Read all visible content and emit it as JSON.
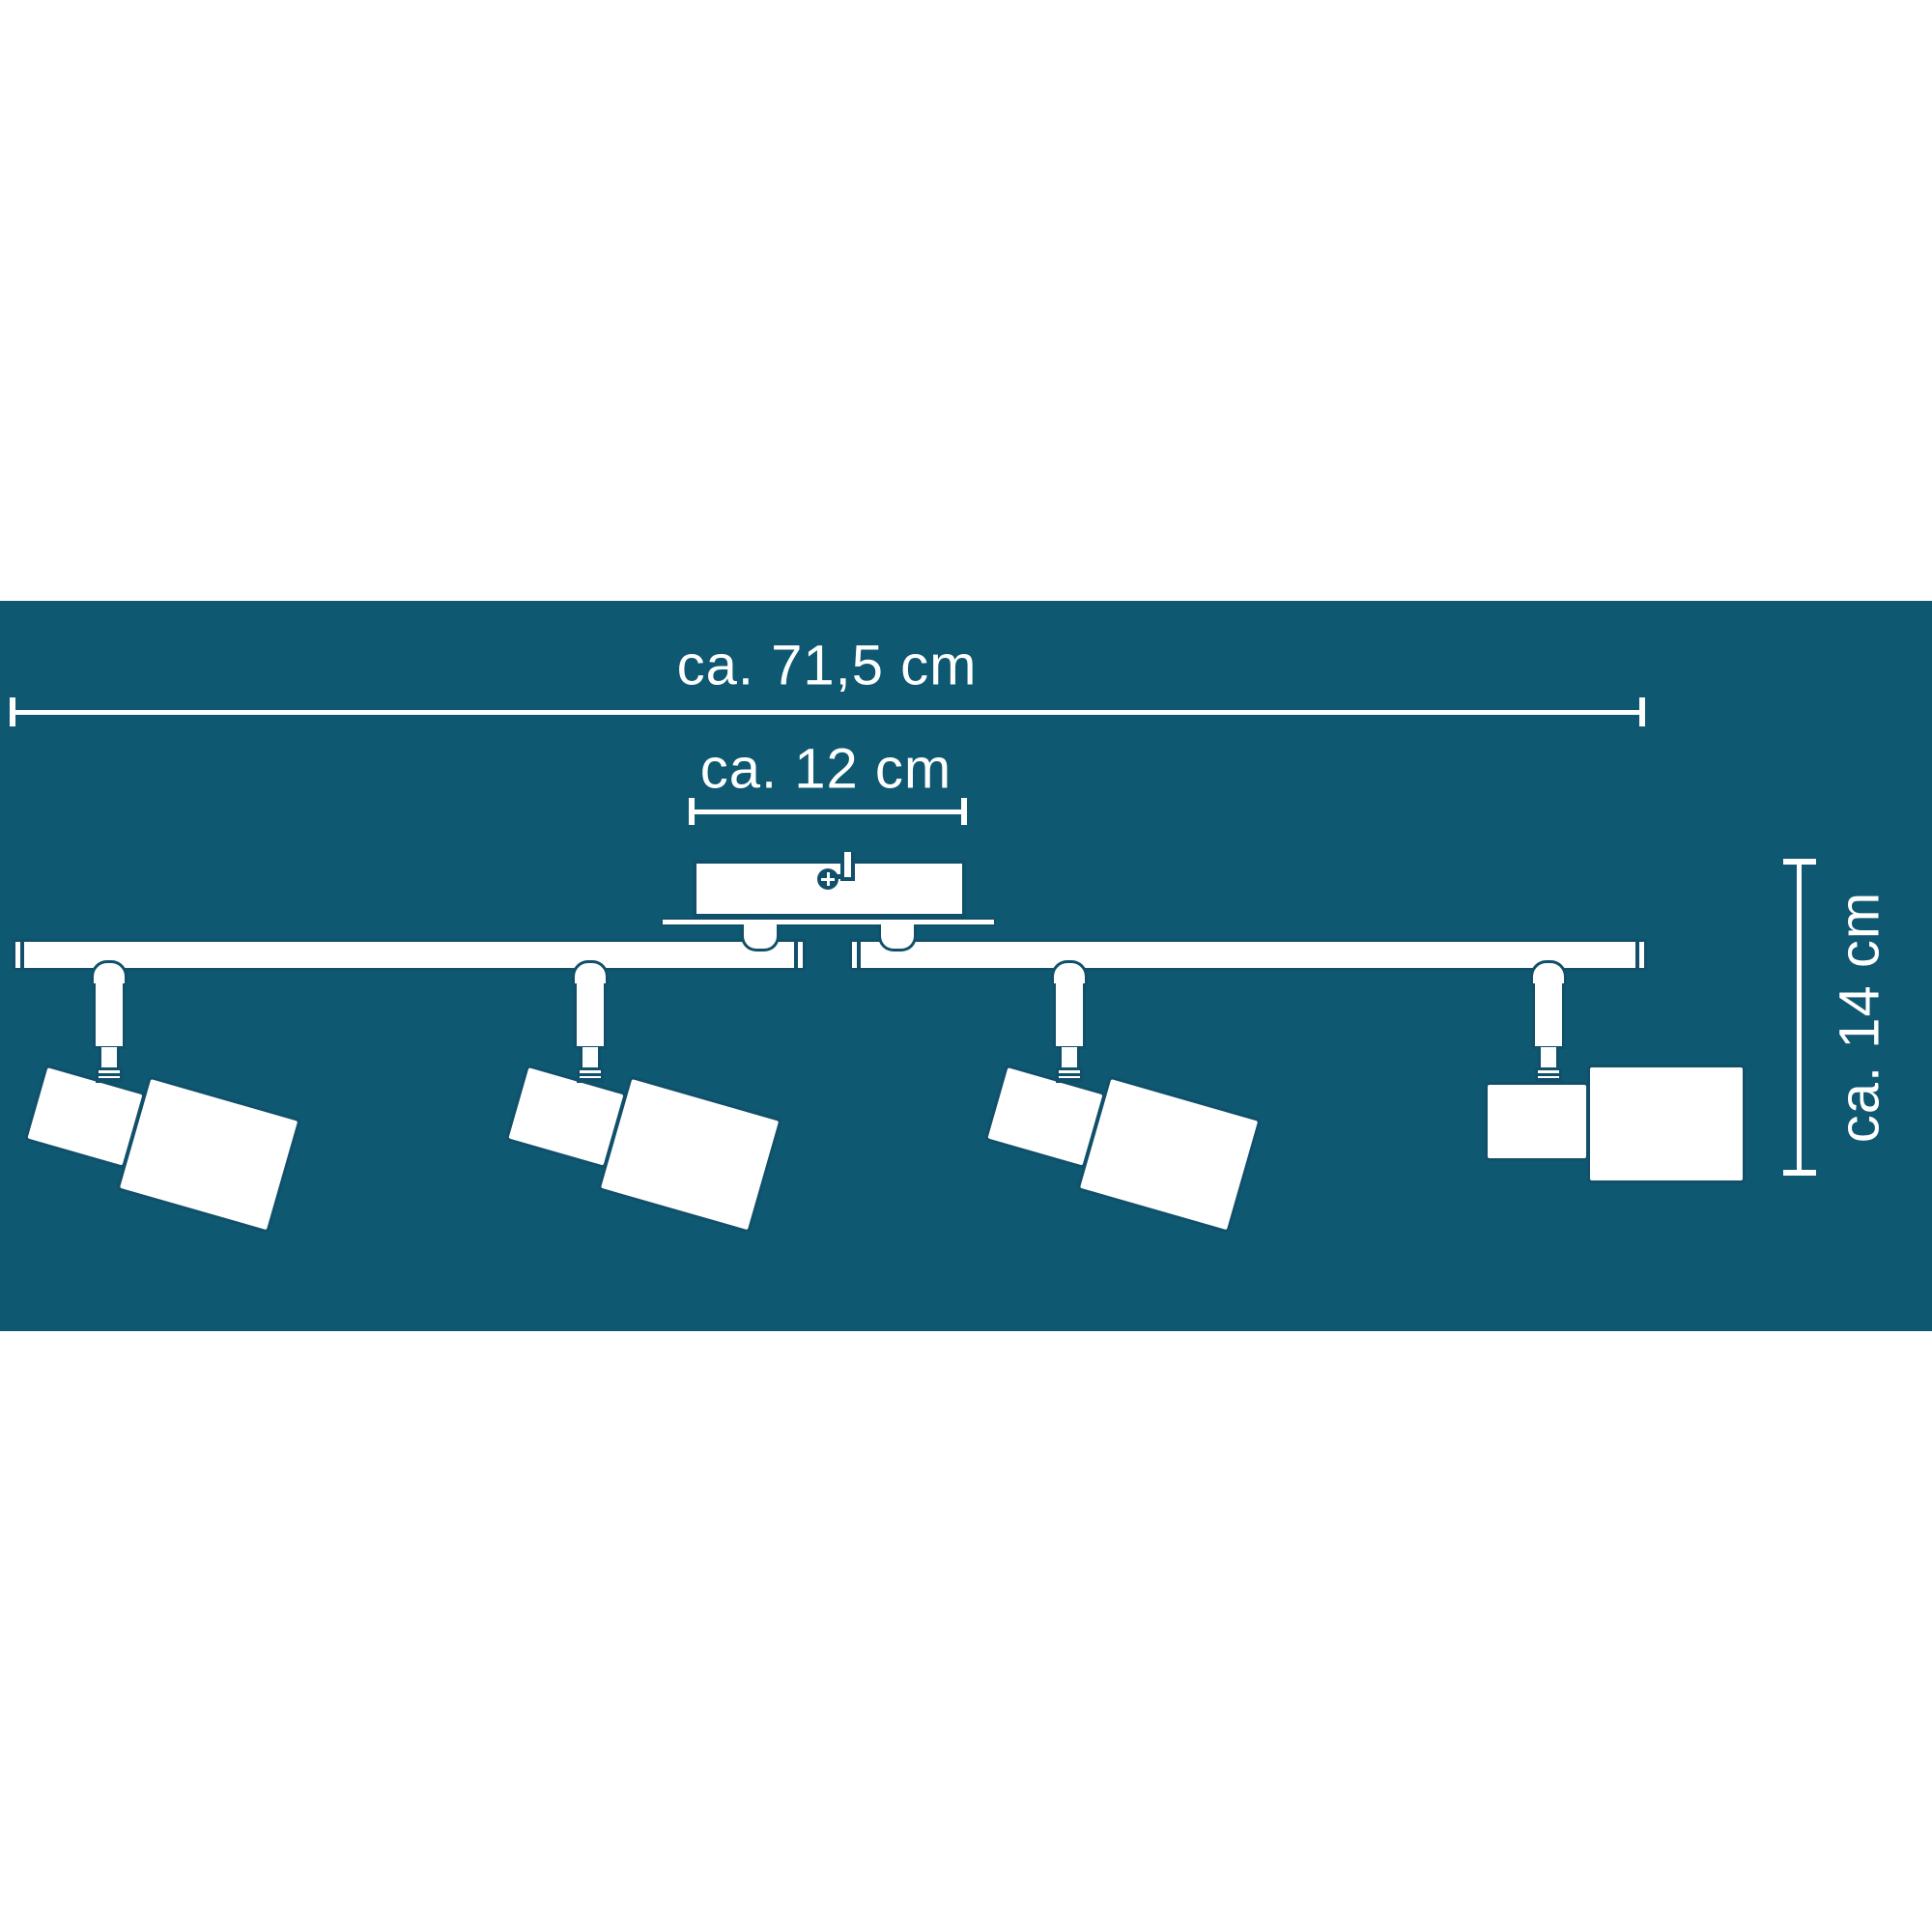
{
  "colors": {
    "panel": "#0e5872",
    "line": "#11506a",
    "fill": "#ffffff",
    "dim": "#ffffff"
  },
  "dimensions": {
    "width_label": "ca. 71,5 cm",
    "canopy_label": "ca. 12 cm",
    "height_label": "ca. 14 cm"
  },
  "fixture": {
    "spot_count": 4,
    "bar_segments": 2,
    "tilted_spots": 3,
    "straight_spots": 1
  }
}
